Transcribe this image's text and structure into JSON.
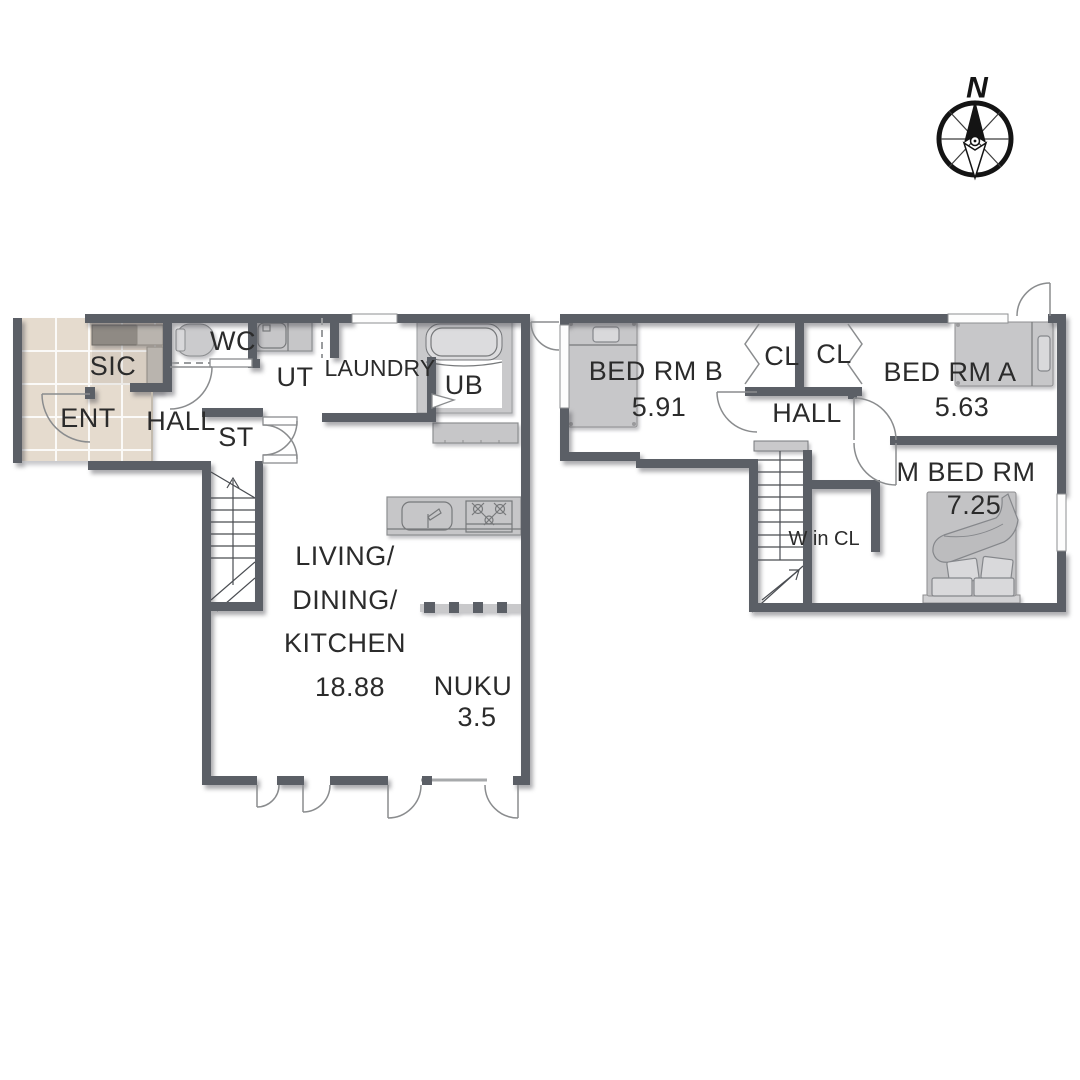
{
  "title": "Two-storey house floor plan",
  "colors": {
    "wall": "#5b5f66",
    "entrance_tile": "#e5dbce",
    "fixture_gray": "#c6c6c8",
    "text": "#2b2b2b",
    "background": "#ffffff"
  },
  "compass": {
    "north_label": "N"
  },
  "first_floor": {
    "rooms": {
      "ent": {
        "label": "ENT"
      },
      "sic": {
        "label": "SIC"
      },
      "hall": {
        "label": "HALL"
      },
      "wc": {
        "label": "WC"
      },
      "ut": {
        "label": "UT"
      },
      "laundry": {
        "label": "LAUNDRY"
      },
      "ub": {
        "label": "UB"
      },
      "st": {
        "label": "ST"
      },
      "ldk": {
        "label_lines": [
          "LIVING/",
          "DINING/",
          "KITCHEN"
        ],
        "area": "18.88"
      },
      "nuku": {
        "label": "NUKU",
        "area": "3.5"
      }
    }
  },
  "second_floor": {
    "rooms": {
      "bed_rm_b": {
        "label": "BED RM B",
        "area": "5.91"
      },
      "cl_left": {
        "label": "CL"
      },
      "cl_right": {
        "label": "CL"
      },
      "bed_rm_a": {
        "label": "BED RM A",
        "area": "5.63"
      },
      "hall": {
        "label": "HALL"
      },
      "w_in_cl": {
        "label": "W in CL"
      },
      "m_bed_rm": {
        "label": "M BED RM",
        "area": "7.25"
      }
    }
  }
}
